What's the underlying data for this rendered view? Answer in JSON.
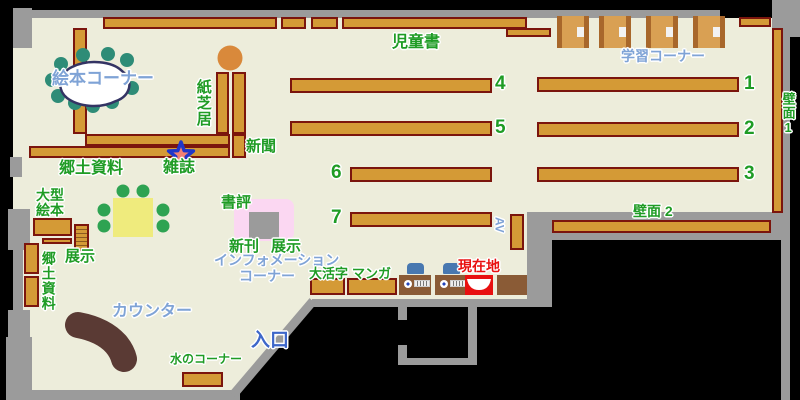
{
  "labels": {
    "picture_book_corner": "絵本コーナー",
    "kamishibai": "紙芝居",
    "newspaper": "新聞",
    "magazines": "雑誌",
    "local_materials": "郷土資料",
    "large_picture_books_line1": "大型",
    "large_picture_books_line2": "絵本",
    "local_materials_vertical": "郷土資料",
    "exhibit_upper": "展示",
    "children_books": "児童書",
    "study_corner": "学習コーナー",
    "wall_1": "壁面1",
    "wall_2": "壁面 2",
    "book_review": "書評",
    "new_arrivals": "新刊",
    "exhibit_info": "展示",
    "information_line1": "インフォメーション",
    "information_line2": "コーナー",
    "large_print": "大活字",
    "manga": "マンガ",
    "av": "AV",
    "current_location": "現在地",
    "counter": "カウンター",
    "water_corner": "水のコーナー",
    "entrance": "入口"
  },
  "shelf_numbers": {
    "n1": "1",
    "n2": "2",
    "n3": "3",
    "n4": "4",
    "n5": "5",
    "n6": "6",
    "n7": "7"
  },
  "colors": {
    "floor": "#EDEDDB",
    "wall": "#9B9B9B",
    "shelf_fill": "#D49A36",
    "shelf_border": "#7B150D",
    "label_green": "#1F9C25",
    "label_blue": "#7FA3D6",
    "entrance_blue": "#3E67C9",
    "current_location_red": "#E81010",
    "counter_brown": "#5A3A34",
    "table_yellow": "#EFEB7D",
    "stool_teal": "#2E8C77",
    "chair_green": "#2EA352",
    "info_pink": "#FBD7F2",
    "star_fill": "#F28073",
    "star_outline": "#2036C8"
  }
}
